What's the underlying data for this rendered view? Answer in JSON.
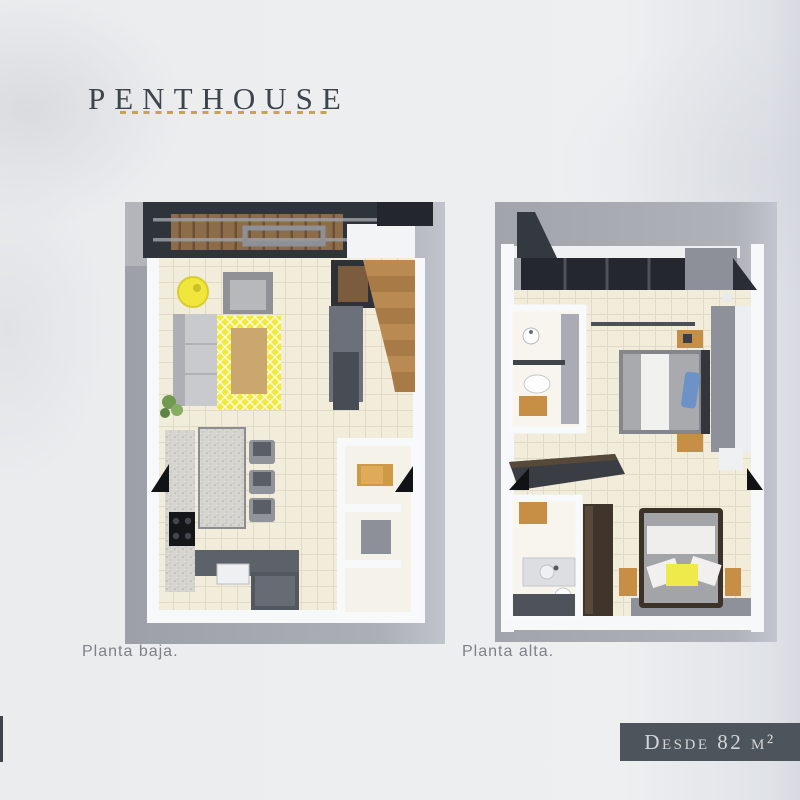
{
  "page": {
    "title": "PENTHOUSE",
    "title_color": "#3e444c",
    "background_color": "#ebedef",
    "accent_color": "#c9a24f"
  },
  "plans": [
    {
      "caption": "Planta baja."
    },
    {
      "caption": "Planta alta."
    }
  ],
  "badge": {
    "text": "Desde 82 m²",
    "background_color": "#4e545b",
    "text_color": "#d3d5d7"
  },
  "palette": {
    "rug_yellow": "#f2e93d",
    "wood_accent": "#c78e45",
    "roof_charcoal": "#2f333a",
    "floor_tile_cream": "#f2ecdb",
    "ground_plane_gray": "#a7a9b1"
  }
}
